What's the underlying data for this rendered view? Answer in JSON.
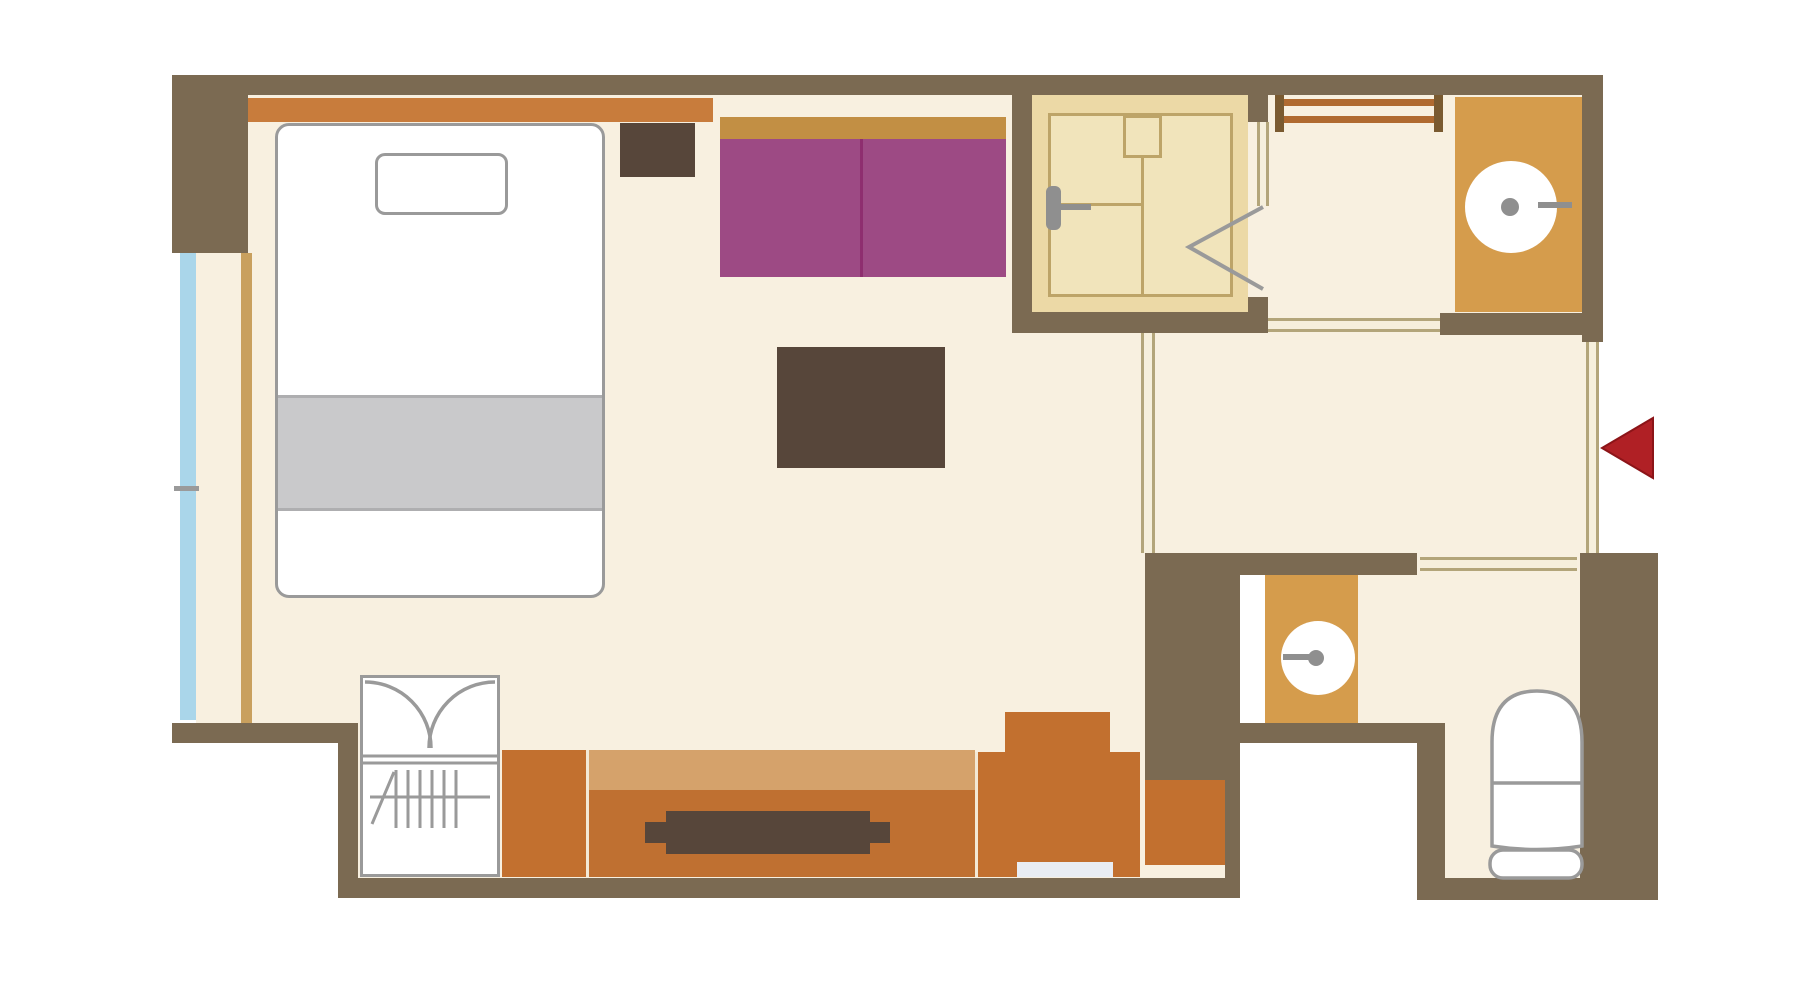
{
  "meta": {
    "type": "floor-plan",
    "text_labels": []
  },
  "colors": {
    "white": "#ffffff",
    "floor": "#f8f0e0",
    "wall": "#7b6a52",
    "gray-border": "#9a9a9a",
    "fixture-gray": "#8f8f8f",
    "shower-floor": "#ecd9a6",
    "shower-tray": "#f1e4bb",
    "shower-line": "#bda468",
    "headboard": "#c87c3c",
    "sofa-back": "#c28f44",
    "sofa": "#9d4a84",
    "sofa-line": "#8e2e6f",
    "dark-furniture": "#57463a",
    "duvet": "#c9c9cb",
    "duvet-edge": "#aeaeb0",
    "curtain": "#c9a05e",
    "window": "#aad6ea",
    "cabinet": "#c2702f",
    "counter-top": "#d5a26b",
    "counter-body": "#bf7031",
    "divider-line": "#f3e9d6",
    "pale-strip": "#e9edf3",
    "vanity": "#d59c4c",
    "rack-post": "#7a5a30",
    "rack-rail": "#b06a30",
    "door-fill": "#f6efdc",
    "door-line": "#b3a57a",
    "red": "#b02025",
    "red-edge": "#8c1418"
  },
  "shapes": [
    {
      "name": "bedroom-floor",
      "x": 248,
      "y": 95,
      "w": 764,
      "h": 628,
      "fill": "floor"
    },
    {
      "name": "window-side-floor",
      "x": 196,
      "y": 253,
      "w": 52,
      "h": 470,
      "fill": "floor"
    },
    {
      "name": "ldk-floor-right",
      "x": 1012,
      "y": 333,
      "w": 143,
      "h": 390,
      "fill": "floor"
    },
    {
      "name": "lower-floor-strip",
      "x": 358,
      "y": 723,
      "w": 882,
      "h": 155,
      "fill": "floor"
    },
    {
      "name": "vanity-corridor-floor",
      "x": 1268,
      "y": 95,
      "w": 314,
      "h": 218,
      "fill": "floor"
    },
    {
      "name": "shower-doorway-floor",
      "x": 1248,
      "y": 122,
      "w": 20,
      "h": 175,
      "fill": "floor"
    },
    {
      "name": "entry-hall-floor",
      "x": 1155,
      "y": 333,
      "w": 432,
      "h": 220,
      "fill": "floor"
    },
    {
      "name": "toilet-room-floor-upper",
      "x": 1358,
      "y": 573,
      "w": 222,
      "h": 150,
      "fill": "floor"
    },
    {
      "name": "toilet-room-floor-lower",
      "x": 1445,
      "y": 723,
      "w": 135,
      "h": 155,
      "fill": "floor"
    },
    {
      "name": "doorway-floor-vanity",
      "x": 1268,
      "y": 313,
      "w": 172,
      "h": 22,
      "fill": "floor"
    },
    {
      "name": "doorway-floor-toilet",
      "x": 1417,
      "y": 553,
      "w": 163,
      "h": 22,
      "fill": "floor"
    },
    {
      "name": "shower-room-floor",
      "x": 1032,
      "y": 95,
      "w": 216,
      "h": 217,
      "fill": "shower-floor"
    },
    {
      "name": "shower-tray",
      "x": 1048,
      "y": 113,
      "w": 185,
      "h": 184,
      "fill": "shower-tray",
      "border": "shower-line",
      "bw": 3
    },
    {
      "name": "shower-control-box",
      "x": 1123,
      "y": 115,
      "w": 39,
      "h": 43,
      "fill": "shower-tray",
      "border": "shower-line",
      "bw": 3
    },
    {
      "name": "shower-divider-vline",
      "x": 1141,
      "y": 158,
      "w": 3,
      "h": 139,
      "fill": "shower-line"
    },
    {
      "name": "shower-divider-hline",
      "x": 1048,
      "y": 203,
      "w": 93,
      "h": 3,
      "fill": "shower-line"
    },
    {
      "name": "shower-head",
      "x": 1046,
      "y": 186,
      "w": 15,
      "h": 44,
      "fill": "fixture-gray",
      "r": 6
    },
    {
      "name": "shower-head-arm",
      "x": 1061,
      "y": 204,
      "w": 30,
      "h": 6,
      "fill": "fixture-gray"
    },
    {
      "name": "headboard",
      "x": 248,
      "y": 98,
      "w": 465,
      "h": 24,
      "fill": "headboard"
    },
    {
      "name": "bed",
      "x": 275,
      "y": 123,
      "w": 330,
      "h": 475,
      "fill": "white",
      "border": "gray-border",
      "bw": 3,
      "r": 14
    },
    {
      "name": "pillow",
      "x": 375,
      "y": 153,
      "w": 133,
      "h": 62,
      "fill": "white",
      "border": "gray-border",
      "bw": 3,
      "r": 10
    },
    {
      "name": "duvet",
      "x": 278,
      "y": 395,
      "w": 324,
      "h": 116,
      "fill": "duvet"
    },
    {
      "name": "duvet-top-edge",
      "x": 278,
      "y": 395,
      "w": 324,
      "h": 3,
      "fill": "duvet-edge"
    },
    {
      "name": "duvet-bottom-edge",
      "x": 278,
      "y": 508,
      "w": 324,
      "h": 3,
      "fill": "duvet-edge"
    },
    {
      "name": "nightstand",
      "x": 620,
      "y": 123,
      "w": 75,
      "h": 54,
      "fill": "dark-furniture"
    },
    {
      "name": "sofa-backrest",
      "x": 720,
      "y": 117,
      "w": 286,
      "h": 22,
      "fill": "sofa-back"
    },
    {
      "name": "sofa-seat",
      "x": 720,
      "y": 139,
      "w": 286,
      "h": 138,
      "fill": "sofa"
    },
    {
      "name": "sofa-divider",
      "x": 860,
      "y": 139,
      "w": 3,
      "h": 138,
      "fill": "sofa-line"
    },
    {
      "name": "coffee-table",
      "x": 777,
      "y": 347,
      "w": 168,
      "h": 121,
      "fill": "dark-furniture"
    },
    {
      "name": "curtain-rail",
      "x": 241,
      "y": 253,
      "w": 11,
      "h": 470,
      "fill": "curtain"
    },
    {
      "name": "window-glass",
      "x": 180,
      "y": 253,
      "w": 16,
      "h": 467,
      "fill": "window"
    },
    {
      "name": "window-mullion",
      "x": 174,
      "y": 486,
      "w": 25,
      "h": 5,
      "fill": "gray-border"
    },
    {
      "name": "wardrobe",
      "x": 360,
      "y": 675,
      "w": 140,
      "h": 202,
      "fill": "white",
      "border": "gray-border",
      "bw": 3
    },
    {
      "name": "cabinet-left",
      "x": 502,
      "y": 750,
      "w": 84,
      "h": 127,
      "fill": "cabinet"
    },
    {
      "name": "cabinet-divider-1",
      "x": 586,
      "y": 750,
      "w": 3,
      "h": 127,
      "fill": "divider-line"
    },
    {
      "name": "tv-board-top",
      "x": 589,
      "y": 750,
      "w": 386,
      "h": 40,
      "fill": "counter-top"
    },
    {
      "name": "tv-board-body",
      "x": 589,
      "y": 790,
      "w": 386,
      "h": 87,
      "fill": "counter-body"
    },
    {
      "name": "tv-screen-bar",
      "x": 645,
      "y": 822,
      "w": 245,
      "h": 21,
      "fill": "dark-furniture"
    },
    {
      "name": "tv-screen-center",
      "x": 666,
      "y": 811,
      "w": 204,
      "h": 43,
      "fill": "dark-furniture"
    },
    {
      "name": "cabinet-divider-2",
      "x": 975,
      "y": 752,
      "w": 3,
      "h": 125,
      "fill": "divider-line"
    },
    {
      "name": "cabinet-mid",
      "x": 978,
      "y": 752,
      "w": 162,
      "h": 125,
      "fill": "cabinet"
    },
    {
      "name": "cabinet-top-box",
      "x": 1005,
      "y": 712,
      "w": 105,
      "h": 40,
      "fill": "cabinet"
    },
    {
      "name": "cabinet-step-strip",
      "x": 1017,
      "y": 862,
      "w": 96,
      "h": 15,
      "fill": "pale-strip"
    },
    {
      "name": "cabinet-lower-right",
      "x": 1145,
      "y": 780,
      "w": 80,
      "h": 85,
      "fill": "cabinet"
    },
    {
      "name": "towel-rack-post-left",
      "x": 1275,
      "y": 85,
      "w": 9,
      "h": 47,
      "fill": "rack-post"
    },
    {
      "name": "towel-rack-post-right",
      "x": 1434,
      "y": 85,
      "w": 9,
      "h": 47,
      "fill": "rack-post"
    },
    {
      "name": "towel-rack-rail-top",
      "x": 1284,
      "y": 99,
      "w": 150,
      "h": 7,
      "fill": "rack-rail"
    },
    {
      "name": "towel-rack-rail-bottom",
      "x": 1284,
      "y": 116,
      "w": 150,
      "h": 7,
      "fill": "rack-rail"
    },
    {
      "name": "vanity-counter-upper",
      "x": 1455,
      "y": 97,
      "w": 127,
      "h": 215,
      "fill": "vanity"
    },
    {
      "name": "sink-upper",
      "x": 1465,
      "y": 161,
      "w": 92,
      "h": 92,
      "fill": "white",
      "r": 46
    },
    {
      "name": "sink-upper-drain",
      "x": 1501,
      "y": 198,
      "w": 18,
      "h": 18,
      "fill": "fixture-gray",
      "r": 9
    },
    {
      "name": "sink-upper-spout",
      "x": 1538,
      "y": 202,
      "w": 34,
      "h": 6,
      "fill": "fixture-gray"
    },
    {
      "name": "vanity-counter-lower",
      "x": 1265,
      "y": 573,
      "w": 93,
      "h": 150,
      "fill": "vanity"
    },
    {
      "name": "sink-lower",
      "x": 1281,
      "y": 621,
      "w": 74,
      "h": 74,
      "fill": "white",
      "r": 37
    },
    {
      "name": "sink-lower-drain",
      "x": 1308,
      "y": 650,
      "w": 16,
      "h": 16,
      "fill": "fixture-gray",
      "r": 8
    },
    {
      "name": "sink-lower-spout",
      "x": 1283,
      "y": 654,
      "w": 26,
      "h": 6,
      "fill": "fixture-gray"
    },
    {
      "name": "wall-top",
      "x": 172,
      "y": 75,
      "w": 1431,
      "h": 20,
      "fill": "wall"
    },
    {
      "name": "wall-left-block",
      "x": 172,
      "y": 95,
      "w": 76,
      "h": 158,
      "fill": "wall"
    },
    {
      "name": "wall-right-upper",
      "x": 1582,
      "y": 95,
      "w": 21,
      "h": 247,
      "fill": "wall"
    },
    {
      "name": "wall-shower-left",
      "x": 1012,
      "y": 95,
      "w": 20,
      "h": 238,
      "fill": "wall"
    },
    {
      "name": "wall-shower-stub-top",
      "x": 1248,
      "y": 95,
      "w": 20,
      "h": 27,
      "fill": "wall"
    },
    {
      "name": "wall-shower-stub-bottom",
      "x": 1248,
      "y": 297,
      "w": 20,
      "h": 36,
      "fill": "wall"
    },
    {
      "name": "wall-shower-bottom",
      "x": 1012,
      "y": 312,
      "w": 256,
      "h": 21,
      "fill": "wall"
    },
    {
      "name": "wall-vanity-bottom",
      "x": 1440,
      "y": 313,
      "w": 163,
      "h": 22,
      "fill": "wall"
    },
    {
      "name": "wall-bedroom-bottom",
      "x": 172,
      "y": 723,
      "w": 186,
      "h": 20,
      "fill": "wall"
    },
    {
      "name": "wall-step-vertical",
      "x": 338,
      "y": 723,
      "w": 20,
      "h": 175,
      "fill": "wall"
    },
    {
      "name": "wall-bottom-long",
      "x": 338,
      "y": 878,
      "w": 902,
      "h": 20,
      "fill": "wall"
    },
    {
      "name": "wall-hall-bottom",
      "x": 1145,
      "y": 553,
      "w": 272,
      "h": 22,
      "fill": "wall"
    },
    {
      "name": "wall-block-a",
      "x": 1145,
      "y": 553,
      "w": 95,
      "h": 227,
      "fill": "wall"
    },
    {
      "name": "wall-c",
      "x": 1240,
      "y": 723,
      "w": 205,
      "h": 20,
      "fill": "wall"
    },
    {
      "name": "wall-d",
      "x": 1417,
      "y": 743,
      "w": 28,
      "h": 157,
      "fill": "wall"
    },
    {
      "name": "wall-toilet-bottom",
      "x": 1417,
      "y": 878,
      "w": 241,
      "h": 22,
      "fill": "wall"
    },
    {
      "name": "wall-corner-column",
      "x": 1580,
      "y": 553,
      "w": 78,
      "h": 347,
      "fill": "wall"
    },
    {
      "name": "wall-dresser-right-strip",
      "x": 1225,
      "y": 780,
      "w": 15,
      "h": 98,
      "fill": "wall"
    },
    {
      "name": "opening-vanity-hall",
      "x": 1268,
      "y": 318,
      "w": 172,
      "h": 14,
      "fill": "door-fill",
      "lines": "h"
    },
    {
      "name": "entrance-door-line",
      "x": 1586,
      "y": 342,
      "w": 13,
      "h": 211,
      "fill": "door-fill",
      "lines": "v"
    },
    {
      "name": "opening-hall-toilet",
      "x": 1420,
      "y": 557,
      "w": 157,
      "h": 14,
      "fill": "door-fill",
      "lines": "h"
    },
    {
      "name": "partition-hall-ldk",
      "x": 1141,
      "y": 333,
      "w": 14,
      "h": 220,
      "fill": "door-fill",
      "lines": "v"
    },
    {
      "name": "shower-door-frame",
      "x": 1257,
      "y": 122,
      "w": 12,
      "h": 84,
      "fill": "door-fill",
      "lines": "v"
    }
  ]
}
